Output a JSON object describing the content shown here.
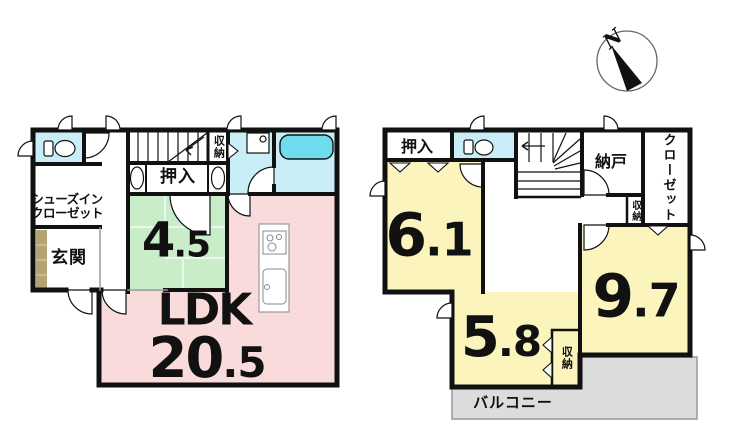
{
  "colors": {
    "wet_room": "#c9eef7",
    "tub": "#6edcec",
    "tatami_room": "#c9ecc9",
    "ldk_room": "#fadbdb",
    "bedroom": "#fbf5bd",
    "balcony": "#dcdcdc",
    "genkan_step": "#b3a476",
    "wall": "#111111"
  },
  "floor1": {
    "shoe_closet_line1": "シューズイン",
    "shoe_closet_line2": "クローゼット",
    "entrance_label": "玄関",
    "closet_label": "押入",
    "storage_label": "収納",
    "tatami_room": {
      "main": "4",
      "decimal": ".5"
    },
    "ldk": {
      "name": "LDK",
      "main": "20",
      "decimal": ".5"
    }
  },
  "floor2": {
    "closet_label": "押入",
    "storage_room_label": "納戸",
    "wardrobe_label": "クローゼット",
    "storage_small_label": "収納",
    "storage_58_label": "収納",
    "room_61": {
      "main": "6",
      "decimal": ".1"
    },
    "room_97": {
      "main": "9",
      "decimal": ".7"
    },
    "room_58": {
      "main": "5",
      "decimal": ".8"
    },
    "balcony_label": "バルコニー"
  },
  "compass": {
    "north_label": "N"
  }
}
